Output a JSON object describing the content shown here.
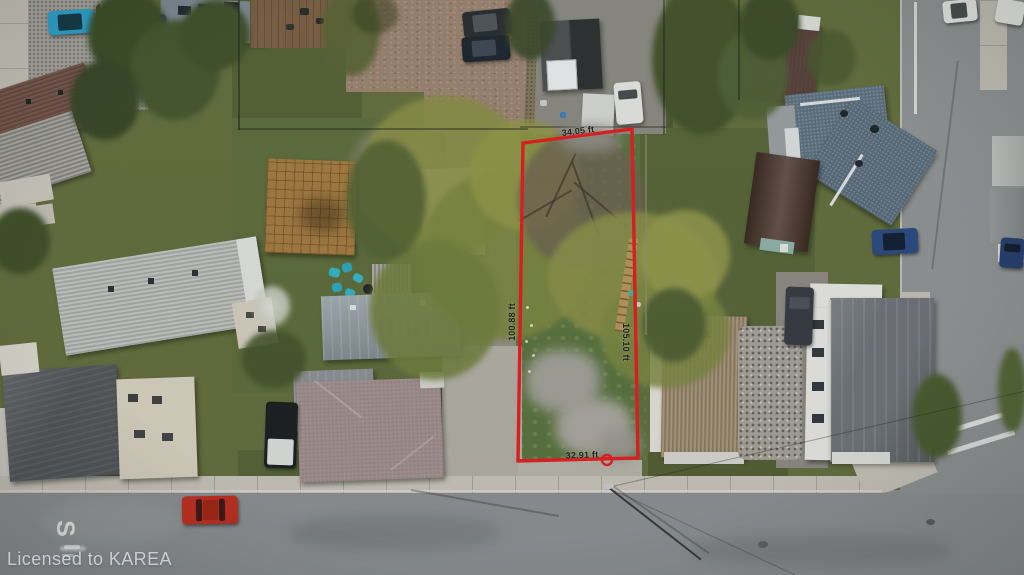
{
  "scene": {
    "type": "aerial-drone-photo",
    "description": "Overhead aerial view of a residential neighborhood with a vacant grass lot outlined in red at a street corner"
  },
  "watermark": {
    "text": "Licensed to KAREA"
  },
  "lot": {
    "boundary_color": "#d71e20",
    "measurements": {
      "top": "34.05 ft",
      "left": "100.88 ft",
      "right": "105.10 ft",
      "bottom": "32.91 ft"
    }
  },
  "road_markings": {
    "letter": "S"
  }
}
